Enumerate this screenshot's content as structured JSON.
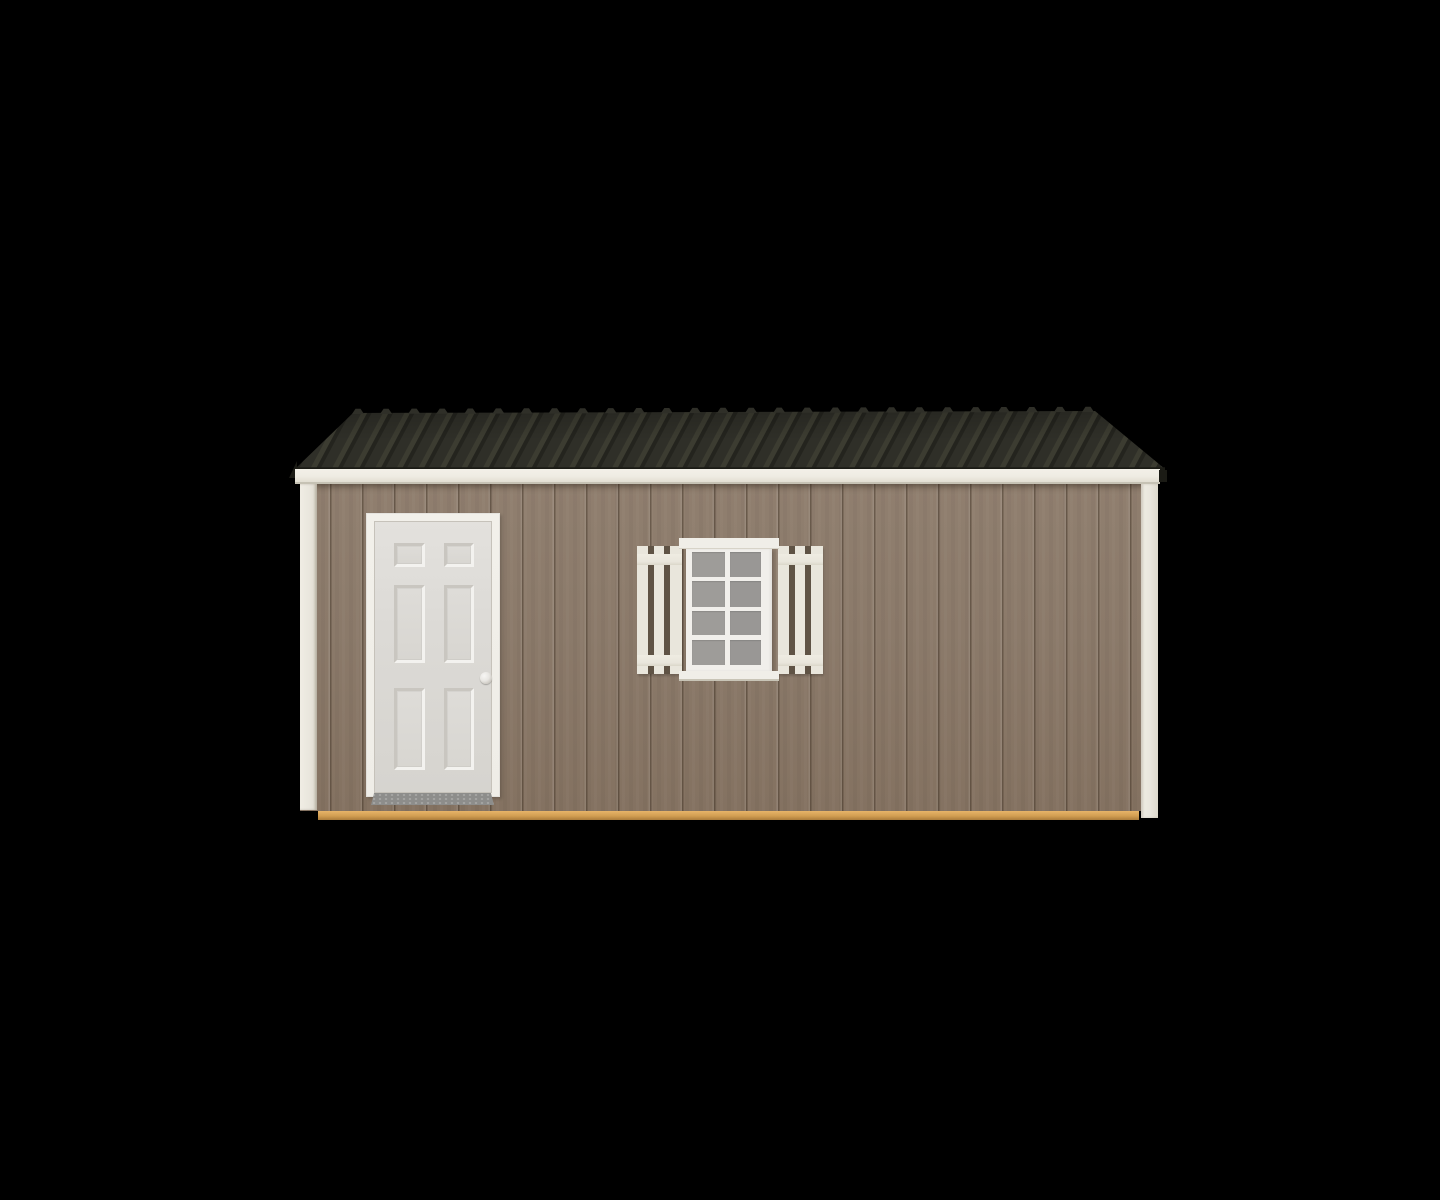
{
  "scene": {
    "description": "3D product render of a portable storage shed, front elevation, centered on a solid black background",
    "object": "storage-shed",
    "view": "front",
    "colors": {
      "background": "#000000",
      "roof_base": "#2f2f28",
      "roof_rib_light": "#3c3c31",
      "roof_rib_dark": "#24241e",
      "roof_edge": "#1b1b15",
      "fascia": "#efece3",
      "fascia_shadow": "#c6c2b4",
      "siding": "#8b7a6a",
      "siding_light": "#907f6f",
      "siding_dark": "#847261",
      "corner_trim": "#e9e6dd",
      "skid_top": "#e7b469",
      "skid": "#d29e52",
      "skid_bottom": "#aa7c3b",
      "door_frame": "#efede7",
      "door_face": "#dcdad6",
      "panel_shadow": "#c9c6c0",
      "panel_highlight": "#f3f2ef",
      "door_knob": "#e8e6e2",
      "threshold": "#8d8d8b",
      "window_trim": "#f0eee8",
      "muntin": "#f1efeb",
      "glass": "#9e9c99",
      "glass_alt": "#999795",
      "shutter": "#e9e6dc",
      "shutter_gap": "#5f5345"
    },
    "parts": {
      "roof": {
        "style": "ribbed-metal-gable-slope",
        "ridge_rib_caps_visible": 27,
        "color_key": "roof_base"
      },
      "fascia_trim": {
        "color_key": "fascia"
      },
      "wall": {
        "material": "vertical-groove-wood-panel-siding",
        "color_key": "siding"
      },
      "corner_trims": {
        "count": 2,
        "color_key": "corner_trim"
      },
      "door": {
        "style": "six-panel",
        "panel_count": 6,
        "knob_side": "right",
        "threshold": "diamond-plate",
        "color_key": "door_face"
      },
      "window": {
        "pane_columns": 2,
        "pane_rows": 4,
        "pane_count": 8,
        "header_trim": true,
        "sill_trim": true,
        "color_key": "window_trim"
      },
      "shutters": {
        "count": 2,
        "style": "spaced-board-with-rails",
        "boards_per_shutter": 3,
        "color_key": "shutter"
      },
      "skid": {
        "material": "wood-runner",
        "color_key": "skid"
      }
    }
  }
}
